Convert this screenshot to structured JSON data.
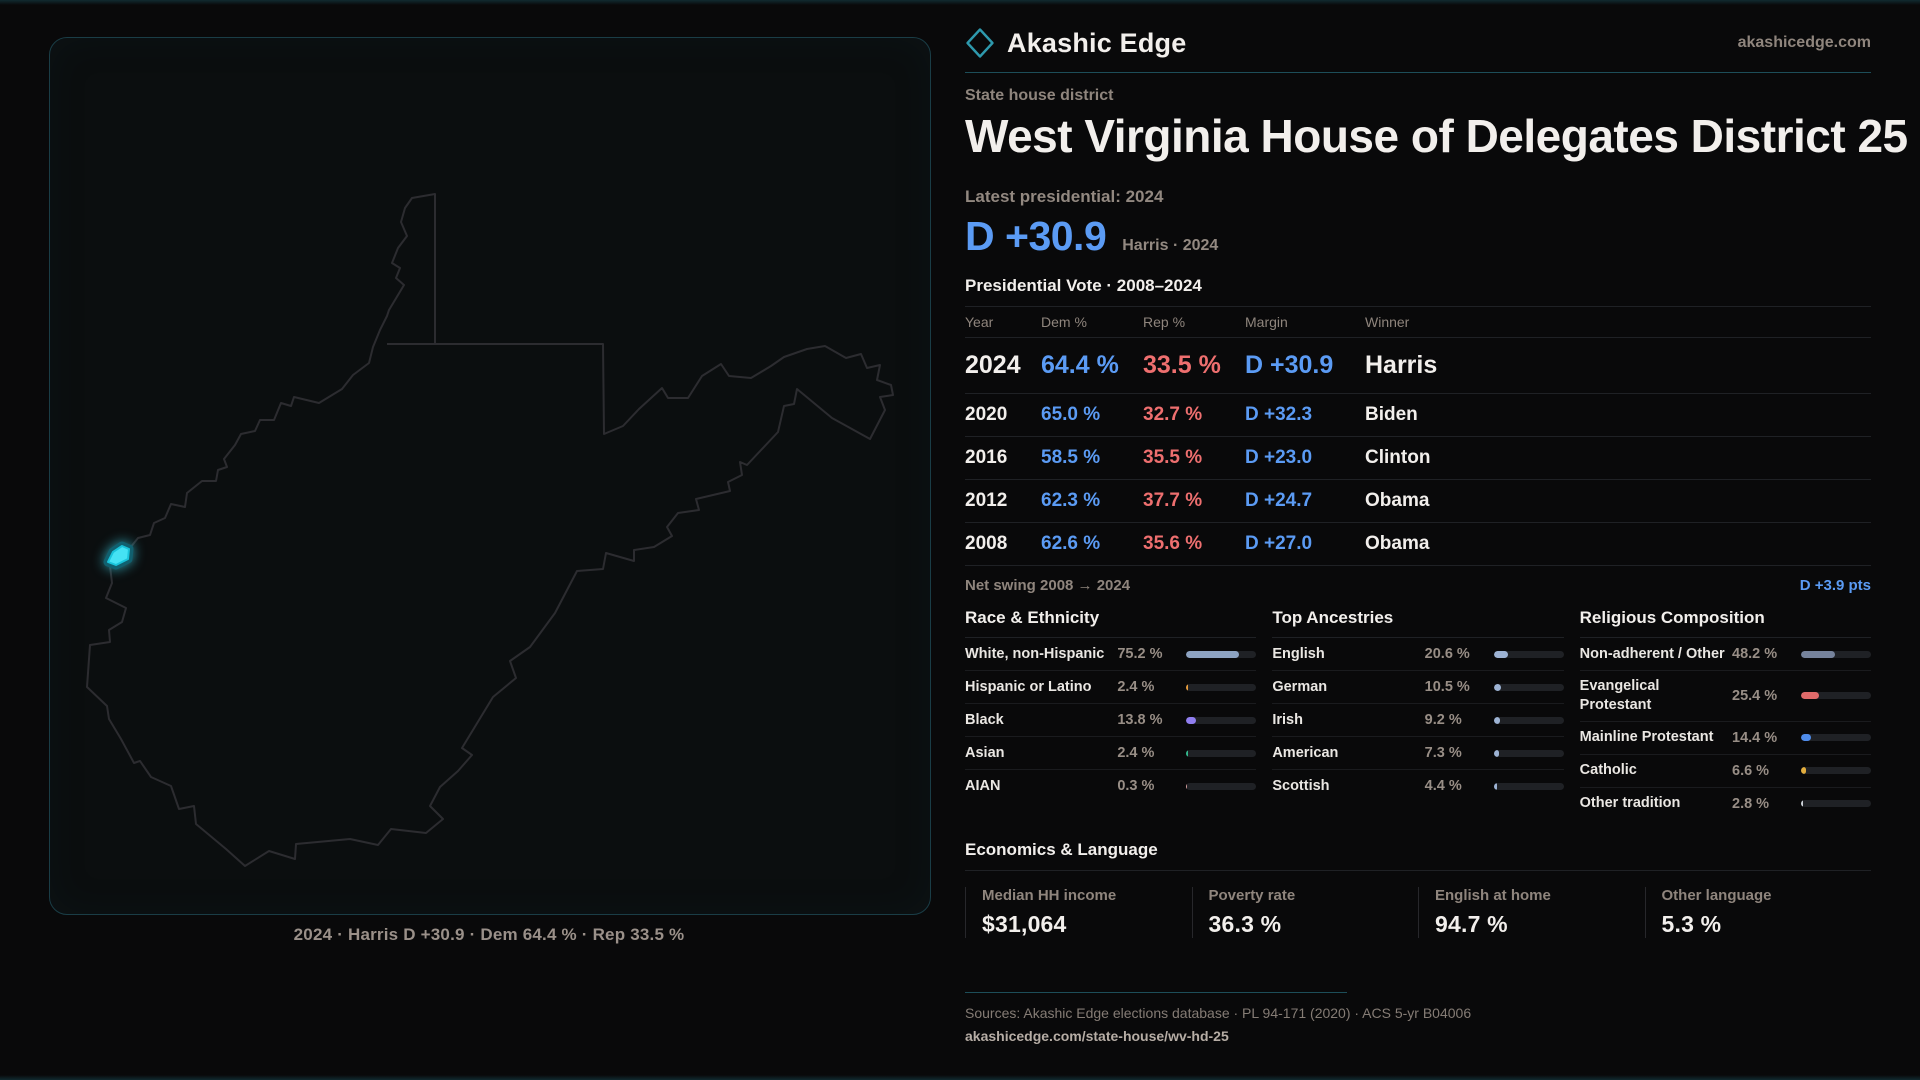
{
  "brand": {
    "name": "Akashic Edge",
    "site": "akashicedge.com"
  },
  "header": {
    "kicker": "State house district",
    "title": "West Virginia House of Delegates District 25"
  },
  "latest": {
    "label": "Latest presidential: 2024",
    "value": "D +30.9",
    "note": "Harris · 2024"
  },
  "table": {
    "title": "Presidential Vote · 2008–2024",
    "columns": [
      "Year",
      "Dem %",
      "Rep %",
      "Margin",
      "Winner"
    ],
    "rows": [
      {
        "year": "2024",
        "dem": "64.4 %",
        "rep": "33.5 %",
        "margin": "D +30.9",
        "winner": "Harris",
        "emphasis": true
      },
      {
        "year": "2020",
        "dem": "65.0 %",
        "rep": "32.7 %",
        "margin": "D +32.3",
        "winner": "Biden"
      },
      {
        "year": "2016",
        "dem": "58.5 %",
        "rep": "35.5 %",
        "margin": "D +23.0",
        "winner": "Clinton"
      },
      {
        "year": "2012",
        "dem": "62.3 %",
        "rep": "37.7 %",
        "margin": "D +24.7",
        "winner": "Obama"
      },
      {
        "year": "2008",
        "dem": "62.6 %",
        "rep": "35.6 %",
        "margin": "D +27.0",
        "winner": "Obama"
      }
    ]
  },
  "net_swing": {
    "label": "Net swing 2008 → 2024",
    "value": "D +3.9 pts"
  },
  "sections": [
    {
      "title": "Race & Ethnicity",
      "rows": [
        {
          "label": "White, non-Hispanic",
          "value": "75.2 %",
          "pct": 75.2,
          "color": "#8da3c2"
        },
        {
          "label": "Hispanic or Latino",
          "value": "2.4 %",
          "pct": 2.4,
          "color": "#e69b3c"
        },
        {
          "label": "Black",
          "value": "13.8 %",
          "pct": 13.8,
          "color": "#907ef0"
        },
        {
          "label": "Asian",
          "value": "2.4 %",
          "pct": 2.4,
          "color": "#33b98d"
        },
        {
          "label": "AIAN",
          "value": "0.3 %",
          "pct": 0.3,
          "color": "#d9a0a0"
        }
      ]
    },
    {
      "title": "Top Ancestries",
      "rows": [
        {
          "label": "English",
          "value": "20.6 %",
          "pct": 20.6,
          "color": "#9db3d4"
        },
        {
          "label": "German",
          "value": "10.5 %",
          "pct": 10.5,
          "color": "#9db3d4"
        },
        {
          "label": "Irish",
          "value": "9.2 %",
          "pct": 9.2,
          "color": "#9db3d4"
        },
        {
          "label": "American",
          "value": "7.3 %",
          "pct": 7.3,
          "color": "#9db3d4"
        },
        {
          "label": "Scottish",
          "value": "4.4 %",
          "pct": 4.4,
          "color": "#9db3d4"
        }
      ]
    },
    {
      "title": "Religious Composition",
      "rows": [
        {
          "label": "Non-adherent / Other",
          "value": "48.2 %",
          "pct": 48.2,
          "color": "#76839c"
        },
        {
          "label": "Evangelical Protestant",
          "value": "25.4 %",
          "pct": 25.4,
          "color": "#df6a6a"
        },
        {
          "label": "Mainline Protestant",
          "value": "14.4 %",
          "pct": 14.4,
          "color": "#4f8ceb"
        },
        {
          "label": "Catholic",
          "value": "6.6 %",
          "pct": 6.6,
          "color": "#e2ad3e"
        },
        {
          "label": "Other tradition",
          "value": "2.8 %",
          "pct": 2.8,
          "color": "#cdd2d8"
        }
      ]
    }
  ],
  "economics": {
    "title": "Economics & Language",
    "stats": [
      {
        "label": "Median HH income",
        "value": "$31,064"
      },
      {
        "label": "Poverty rate",
        "value": "36.3 %"
      },
      {
        "label": "English at home",
        "value": "94.7 %"
      },
      {
        "label": "Other language",
        "value": "5.3 %"
      }
    ]
  },
  "map": {
    "state": "West Virginia",
    "caption": "2024 · Harris D +30.9 · Dem 64.4 % · Rep 33.5 %",
    "highlight_color": "#45e2f4",
    "outline_color": "#2c2c30"
  },
  "footer": {
    "sources": "Sources: Akashic Edge elections database · PL 94-171 (2020) · ACS 5-yr B04006",
    "url": "akashicedge.com/state-house/wv-hd-25"
  },
  "colors": {
    "dem_blue": "#5b9bf4",
    "rep_red": "#ee6f6f",
    "teal_rule": "#1d4e59"
  },
  "chart_data": [
    {
      "type": "table",
      "title": "Presidential Vote · 2008–2024",
      "columns": [
        "Year",
        "Dem %",
        "Rep %",
        "Margin",
        "Winner"
      ],
      "rows": [
        [
          2024,
          64.4,
          33.5,
          "D +30.9",
          "Harris"
        ],
        [
          2020,
          65.0,
          32.7,
          "D +32.3",
          "Biden"
        ],
        [
          2016,
          58.5,
          35.5,
          "D +23.0",
          "Clinton"
        ],
        [
          2012,
          62.3,
          37.7,
          "D +24.7",
          "Obama"
        ],
        [
          2008,
          62.6,
          35.6,
          "D +27.0",
          "Obama"
        ]
      ]
    },
    {
      "type": "bar",
      "title": "Race & Ethnicity",
      "categories": [
        "White, non-Hispanic",
        "Hispanic or Latino",
        "Black",
        "Asian",
        "AIAN"
      ],
      "values": [
        75.2,
        2.4,
        13.8,
        2.4,
        0.3
      ],
      "xlim": [
        0,
        100
      ],
      "unit": "%"
    },
    {
      "type": "bar",
      "title": "Top Ancestries",
      "categories": [
        "English",
        "German",
        "Irish",
        "American",
        "Scottish"
      ],
      "values": [
        20.6,
        10.5,
        9.2,
        7.3,
        4.4
      ],
      "xlim": [
        0,
        100
      ],
      "unit": "%"
    },
    {
      "type": "bar",
      "title": "Religious Composition",
      "categories": [
        "Non-adherent / Other",
        "Evangelical Protestant",
        "Mainline Protestant",
        "Catholic",
        "Other tradition"
      ],
      "values": [
        48.2,
        25.4,
        14.4,
        6.6,
        2.8
      ],
      "xlim": [
        0,
        100
      ],
      "unit": "%"
    },
    {
      "type": "table",
      "title": "Economics & Language",
      "columns": [
        "Median HH income",
        "Poverty rate",
        "English at home",
        "Other language"
      ],
      "rows": [
        [
          "$31,064",
          "36.3 %",
          "94.7 %",
          "5.3 %"
        ]
      ]
    }
  ]
}
